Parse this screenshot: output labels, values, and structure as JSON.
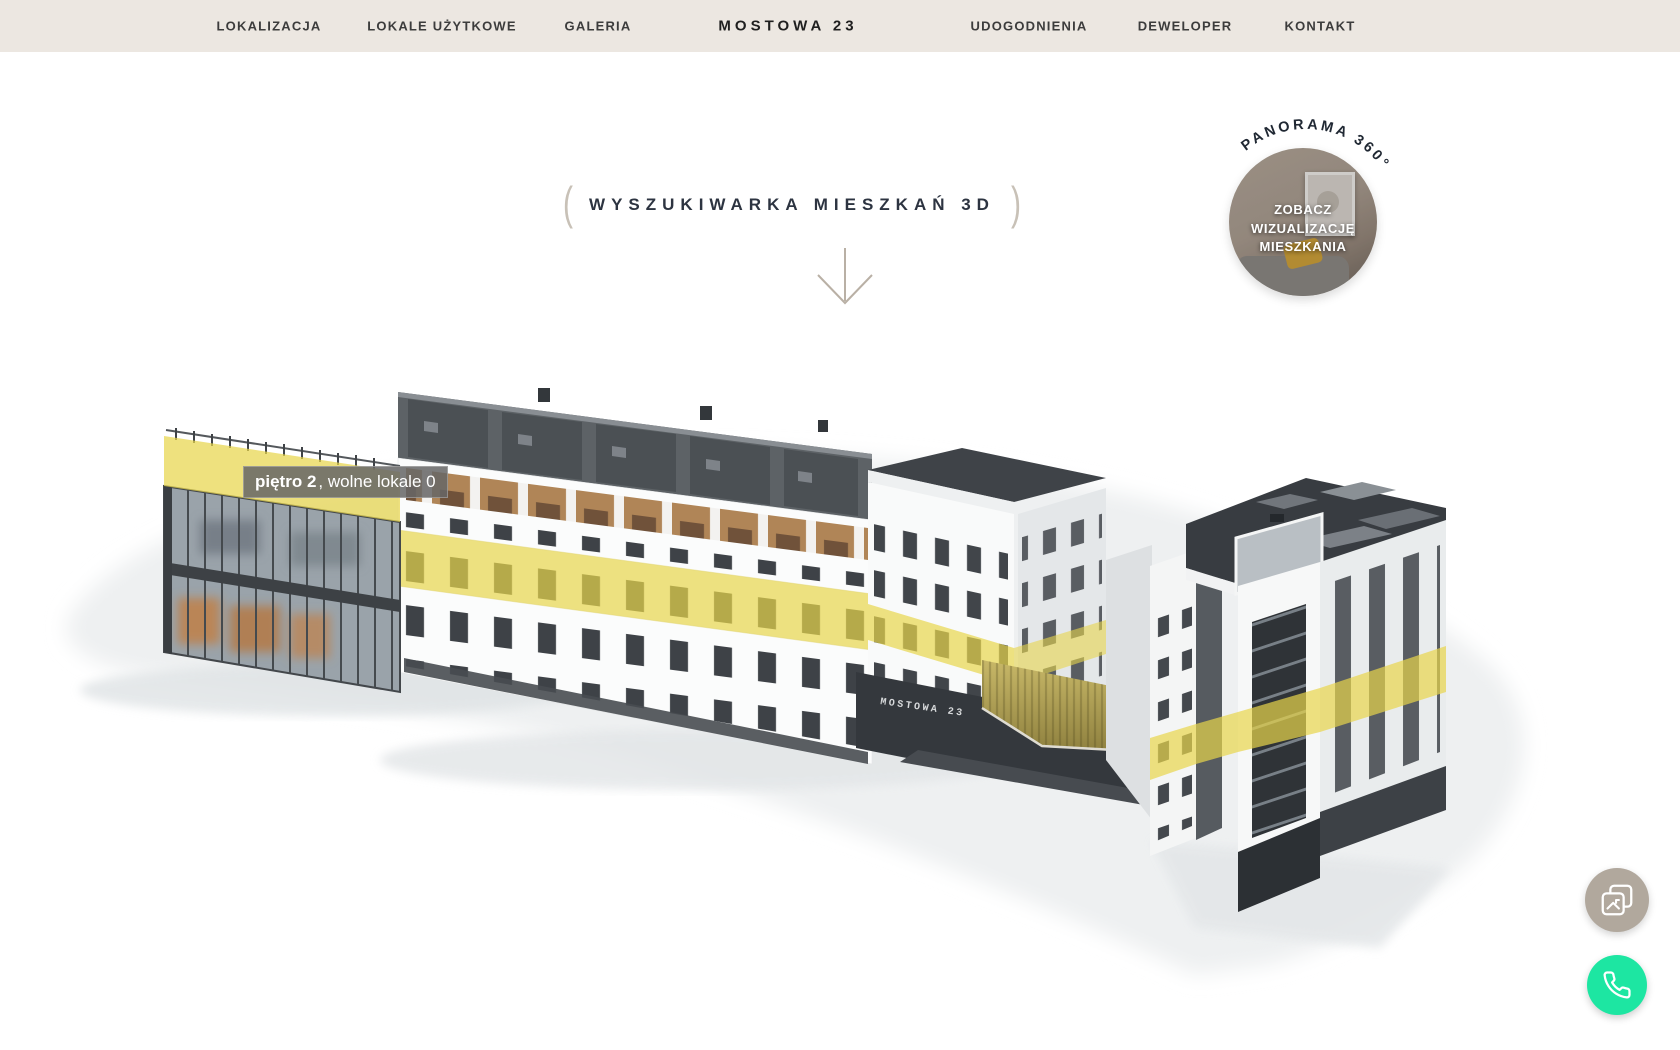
{
  "nav": {
    "left": [
      {
        "label": "LOKALIZACJA"
      },
      {
        "label": "LOKALE UŻYTKOWE"
      },
      {
        "label": "GALERIA"
      }
    ],
    "brand": "MOSTOWA 23",
    "right": [
      {
        "label": "UDOGODNIENIA"
      },
      {
        "label": "DEWELOPER"
      },
      {
        "label": "KONTAKT"
      }
    ]
  },
  "hero": {
    "heading": "WYSZUKIWARKA MIESZKAŃ 3D",
    "paren_open": "(",
    "paren_close": ")"
  },
  "panorama_badge": {
    "arc_text": "PANORAMA 360°",
    "cta_line1": "ZOBACZ",
    "cta_line2": "WIZUALIZACJĘ",
    "cta_line3": "MIESZKANIA"
  },
  "building": {
    "sign_text": "MOSTOWA 23",
    "floor_tooltip": {
      "floor": "piętro 2",
      "availability": ", wolne lokale 0"
    }
  },
  "colors": {
    "header_bg": "#ece7e1",
    "heading": "#2d3441",
    "accent_yellow": "#e8d64c",
    "phone_green": "#1de6a2",
    "gallery_gray": "#b1a89d",
    "roof_dark": "#3b3f44"
  }
}
